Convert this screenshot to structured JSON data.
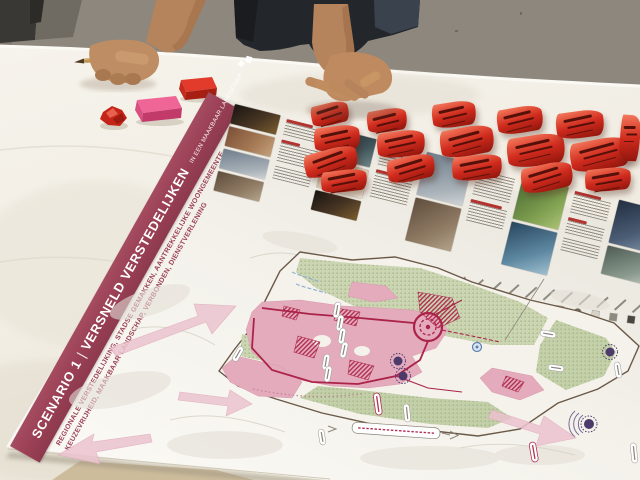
{
  "scene": {
    "description": "Photograph of a workshop table: a printed urban-planning scenario poster lies on a white tablecloth, covered with curled red sticky notes; two participants' hands rest on the table, one holding a pencil beside pink and red sticky-note pads and a crumpled red note.",
    "wall_color": "#8d877d",
    "tablecloth_color": "#f3f0e8"
  },
  "poster": {
    "banner": {
      "background_color": "#9c4156",
      "scenario_label": "SCENARIO 1",
      "separator": "|",
      "title": "VERSNELD VERSTEDELIJKEN",
      "title_suffix": "IN EEN MAAKBAAR LANDSCHAP"
    },
    "keywords_line1": "REGIONALE VERSTEDELIJKING, STADSE GEMAKKEN, AANTREKKELIJKE WOONGEMEENTE,",
    "keywords_line2": "KEUZEVRIJHEID, MAAKBAAR LANDSCHAP, VERBONDEN, DIENSTVERLENING",
    "accent_color": "#9c4156",
    "photo_strip": {
      "tile_count": 13,
      "note": "reference photos with captions; caption text not legible in source image"
    },
    "map": {
      "urban_color": "#e3abbc",
      "urban_accent_hatch": "#b23053",
      "landscape_color": "#cbd5b2",
      "route_color": "#ab2348",
      "marker_purple": "#4c3a6b",
      "marker_blue": "#5b7fae",
      "flow_arrow_pink": "#ecc3cf",
      "boundary_color": "#6b5948"
    },
    "legend_swatches": [
      "#8f2030",
      "#c2607f",
      "#e3abbc",
      "#5d2a3a",
      "#b23053",
      "#7e8c5a",
      "#a7b97f",
      "#55604a",
      "#4c3a6b",
      "#2f2a3a",
      "#cbd5b2",
      "#9db8d2",
      "#b5a98f",
      "#6d6a5f",
      "#d8d3c8",
      "#8f8a7e",
      "#4a4640"
    ]
  },
  "items": {
    "sticky_note_color": "#cf2a1d",
    "sticky_note_count": 17,
    "sticky_pad_pink_color": "#ef6696",
    "sticky_pad_red_color": "#e23a2b",
    "pencil_color": "#c09552"
  }
}
